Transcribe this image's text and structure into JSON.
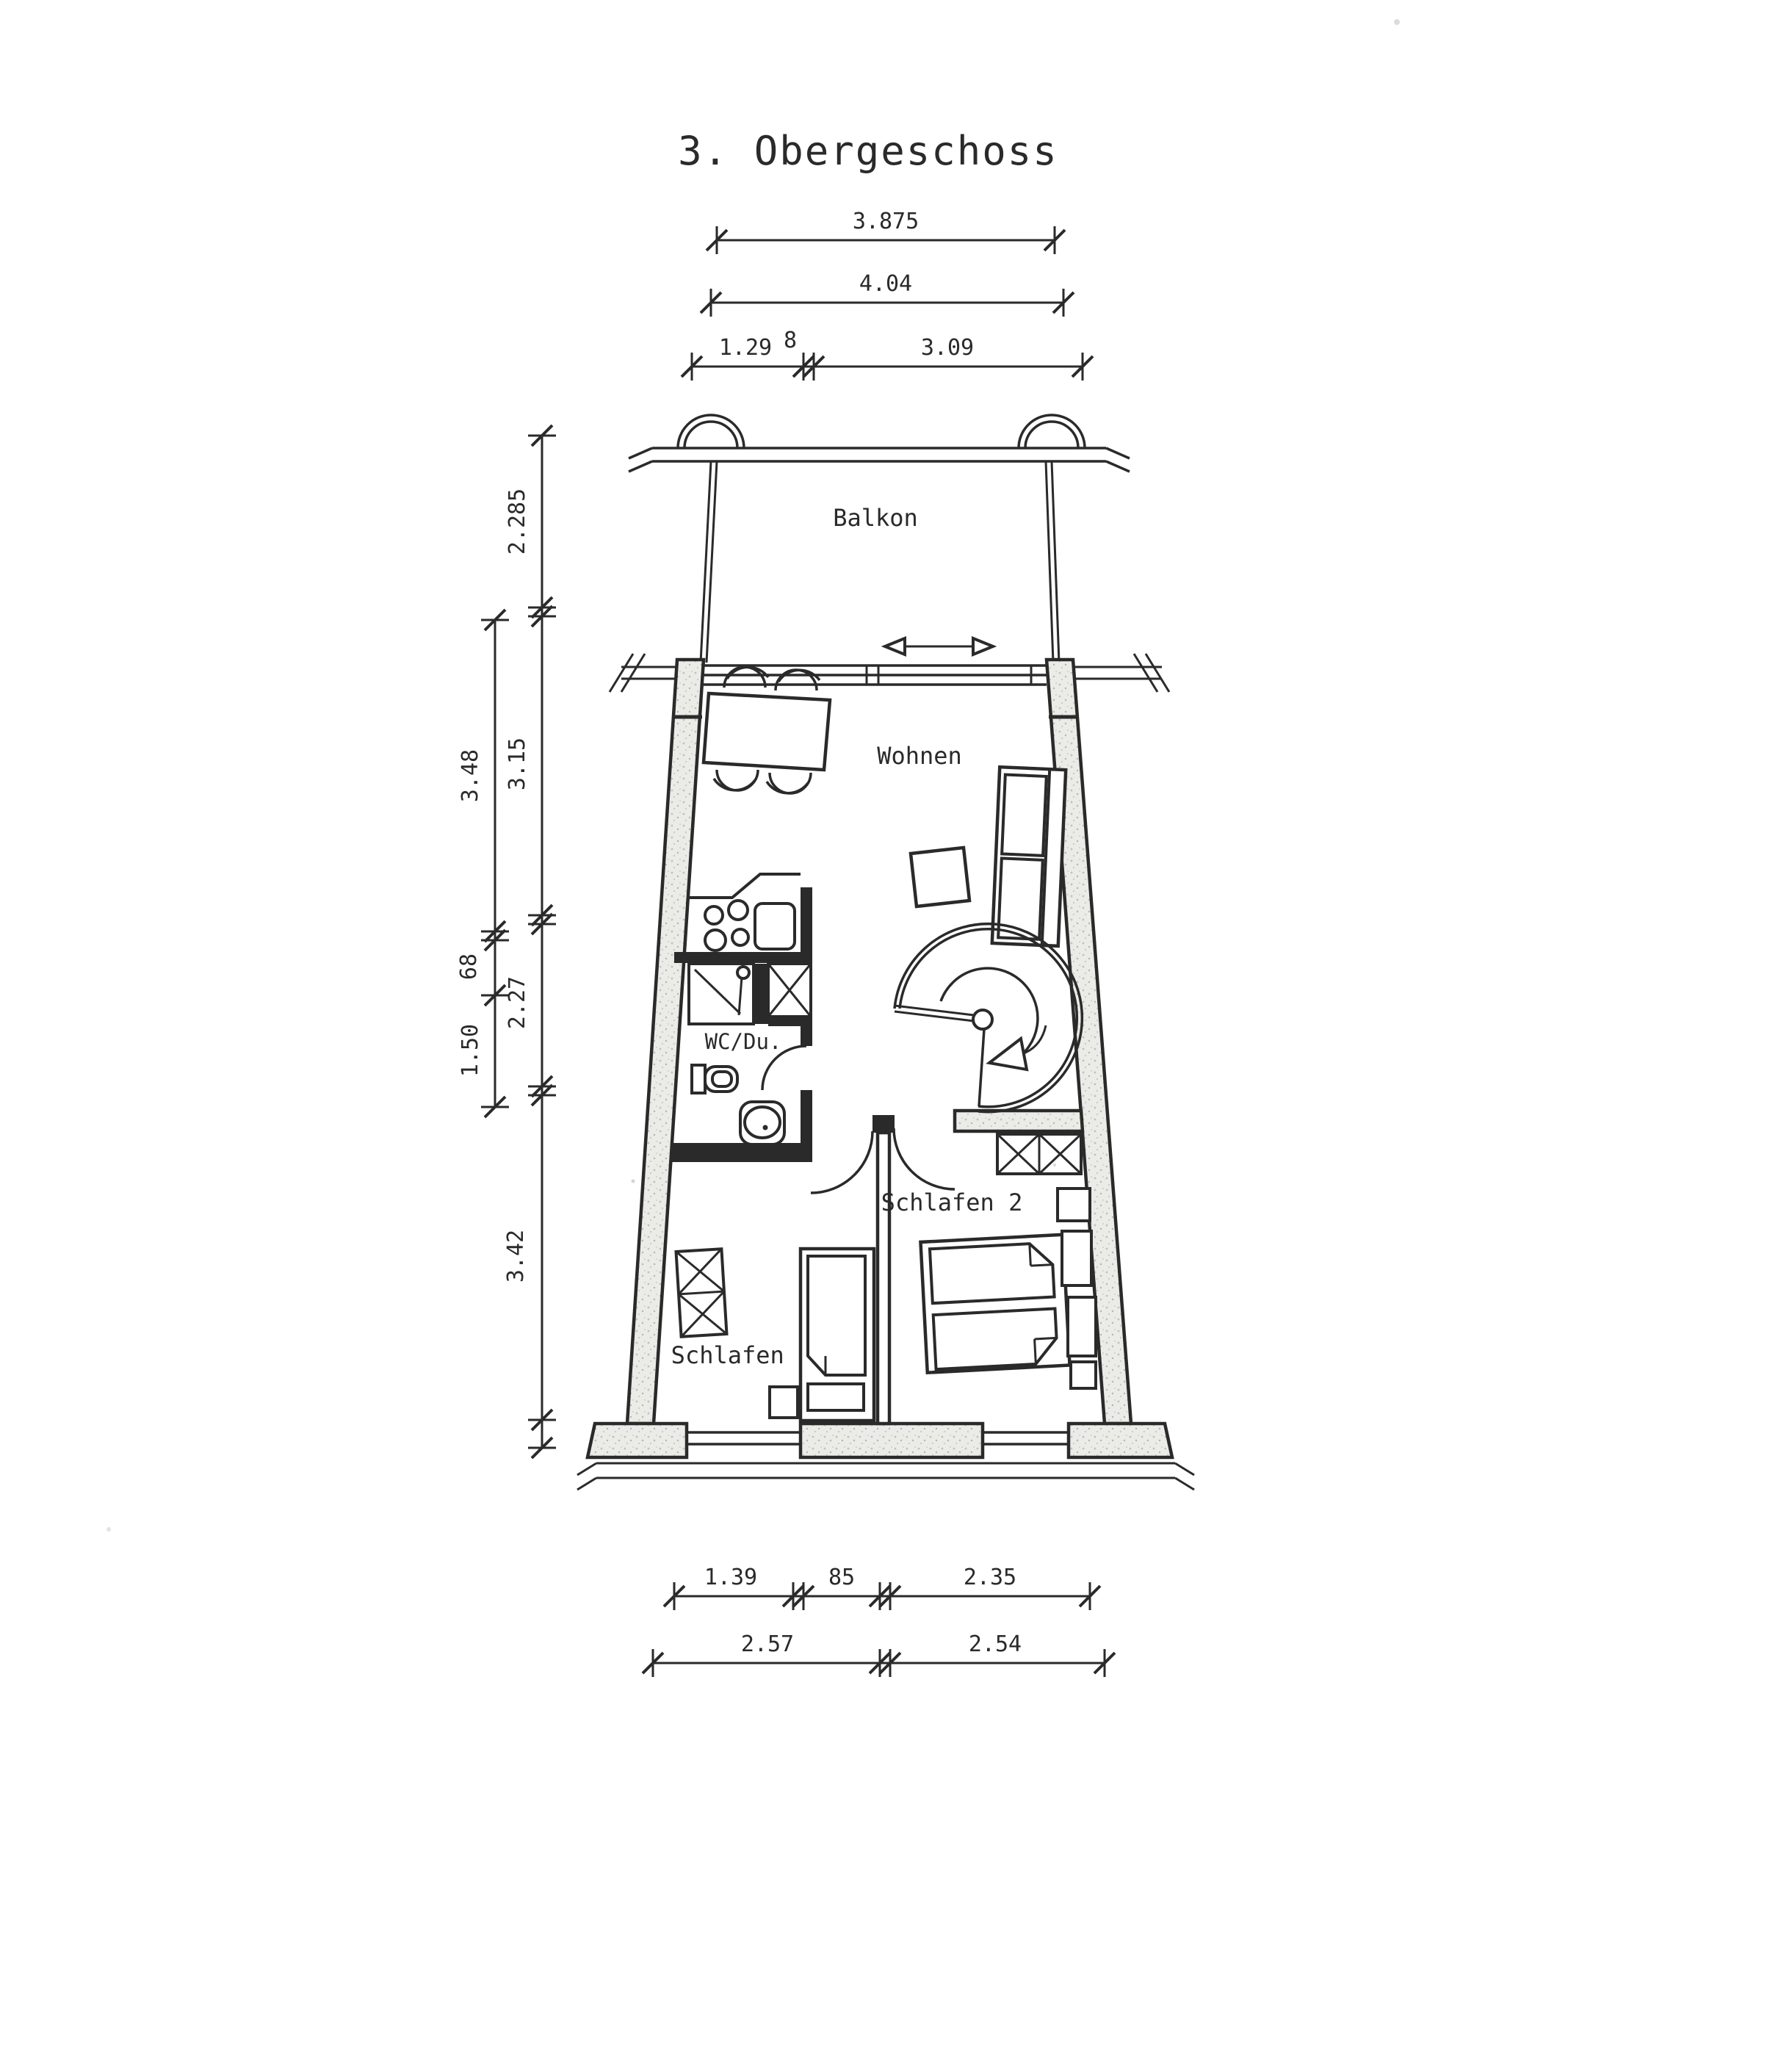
{
  "title": "3. Obergeschoss",
  "rooms": {
    "balkon": "Balkon",
    "wohnen": "Wohnen",
    "wc_du": "WC/Du.",
    "schlafen1": "Schlafen 1",
    "schlafen2": "Schlafen 2"
  },
  "dims": {
    "top": [
      "3.875",
      "4.04",
      "1.29",
      "8",
      "3.09"
    ],
    "left": [
      "2.285",
      "3.48",
      "3.15",
      "68",
      "2.27",
      "1.50",
      "3.42"
    ],
    "bottom": [
      "1.39",
      "85",
      "2.35",
      "2.57",
      "2.54"
    ]
  },
  "colors": {
    "ink": "#2a2a2a",
    "paper": "#ffffff",
    "wall_fill": "#ebebe7"
  }
}
